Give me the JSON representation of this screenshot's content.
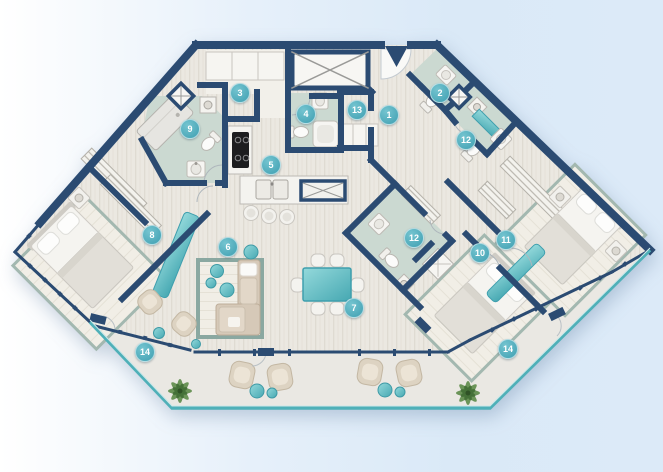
{
  "plan": {
    "kind": "apartment-floor-plan",
    "entrance_icon": "entrance-arrow-icon",
    "palette": {
      "wall": "#2b4b72",
      "accent_teal": "#53b2bf",
      "badge_teal": "#46a8b9",
      "floor_wood": "#ebe8e1",
      "floor_bathroom": "#cbd9d1",
      "floor_balcony": "#eae8e3",
      "rug_border": "#9fb6ae",
      "furniture_beige": "#d8ccbb",
      "plant_green": "#5e8c4a",
      "background_left": "#ffffff",
      "background_right": "#d9e8f7"
    },
    "badges": [
      {
        "label": "1",
        "x": 389,
        "y": 115
      },
      {
        "label": "2",
        "x": 440,
        "y": 93
      },
      {
        "label": "3",
        "x": 240,
        "y": 93
      },
      {
        "label": "4",
        "x": 306,
        "y": 114
      },
      {
        "label": "5",
        "x": 271,
        "y": 165
      },
      {
        "label": "6",
        "x": 228,
        "y": 247
      },
      {
        "label": "7",
        "x": 354,
        "y": 308
      },
      {
        "label": "8",
        "x": 152,
        "y": 235
      },
      {
        "label": "9",
        "x": 190,
        "y": 129
      },
      {
        "label": "10",
        "x": 480,
        "y": 253
      },
      {
        "label": "11",
        "x": 506,
        "y": 240
      },
      {
        "label": "12",
        "x": 466,
        "y": 140
      },
      {
        "label": "12",
        "x": 414,
        "y": 238
      },
      {
        "label": "13",
        "x": 357,
        "y": 110
      },
      {
        "label": "14",
        "x": 145,
        "y": 352
      },
      {
        "label": "14",
        "x": 508,
        "y": 349
      }
    ]
  }
}
